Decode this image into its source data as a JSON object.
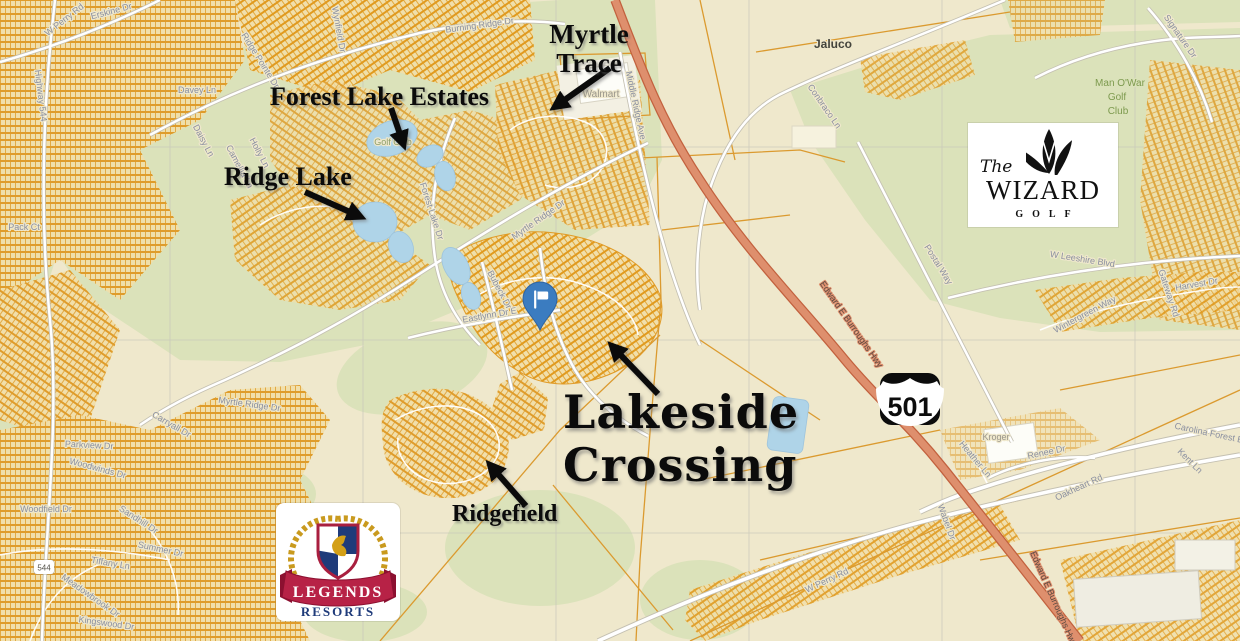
{
  "annotations": {
    "myrtle_trace": {
      "line1": "Myrtle",
      "line2": "Trace"
    },
    "forest_lake_estates": "Forest Lake Estates",
    "ridge_lake": "Ridge Lake",
    "lakeside_crossing": {
      "line1": "Lakeside",
      "line2": "Crossing"
    },
    "ridgefield": "Ridgefield"
  },
  "logos": {
    "wizard": {
      "prefix": "The",
      "name": "WIZARD",
      "tagline": "GOLF"
    },
    "legends": {
      "name": "LEGENDS",
      "tagline": "RESORTS"
    }
  },
  "markers": {
    "route_shield": "501",
    "route_544": "544"
  },
  "map_labels": {
    "walmart": "Walmart",
    "jaluco": "Jaluco",
    "kroger": "Kroger",
    "golf_club": "Golf Club",
    "man_o_war": {
      "line1": "Man O'War",
      "line2": "Golf",
      "line3": "Club"
    },
    "streets": [
      "Burning Ridge Dr",
      "W Perry Rd",
      "Erskine Dr",
      "Davey Ln",
      "Ridge Pointe Dr",
      "Daisy Ln",
      "Camellia Ln",
      "Holly Ln",
      "Highway 544",
      "Pack Ct",
      "Middle Ridge Ave",
      "Conbraco Ln",
      "Signature Dr",
      "W Leeshire Blvd",
      "Postal Way",
      "Edward E Burroughs Hwy",
      "Edward E Burroughs Hwy",
      "Myrtle Ridge Dr",
      "Forest Lake Dr",
      "Eastlynn Dr E",
      "Bubeck Dr",
      "Renee Dr",
      "Oakheart Rd",
      "Carolina Forest Blvd",
      "Kent Ln",
      "Heather Ln",
      "Wabel Dr",
      "Wintergreen Way",
      "Harvest Dr",
      "Gateway Rd",
      "Woodfield Dr",
      "Woodwinds Dr",
      "Parkview Dr",
      "Sandhill Dr",
      "Summer Dr",
      "Tiffany Ln",
      "Meadowbrook Dr",
      "Kingswood Dr",
      "Myrtle Ridge Dr",
      "Carryall Dr",
      "W Perry Rd",
      "Wynfield Dr"
    ]
  },
  "colors": {
    "background": "#EFE8CC",
    "green": "#DBE2BA",
    "parcel_orange": "#E09B28",
    "highway_fill": "#DE8F6D",
    "highway_casing": "#C2613E",
    "water": "#AFD4E8",
    "pin_blue": "#3B7CC0",
    "legends_red": "#B72246",
    "legends_navy": "#1F3B7A",
    "wreath_gold": "#C99A1E"
  }
}
